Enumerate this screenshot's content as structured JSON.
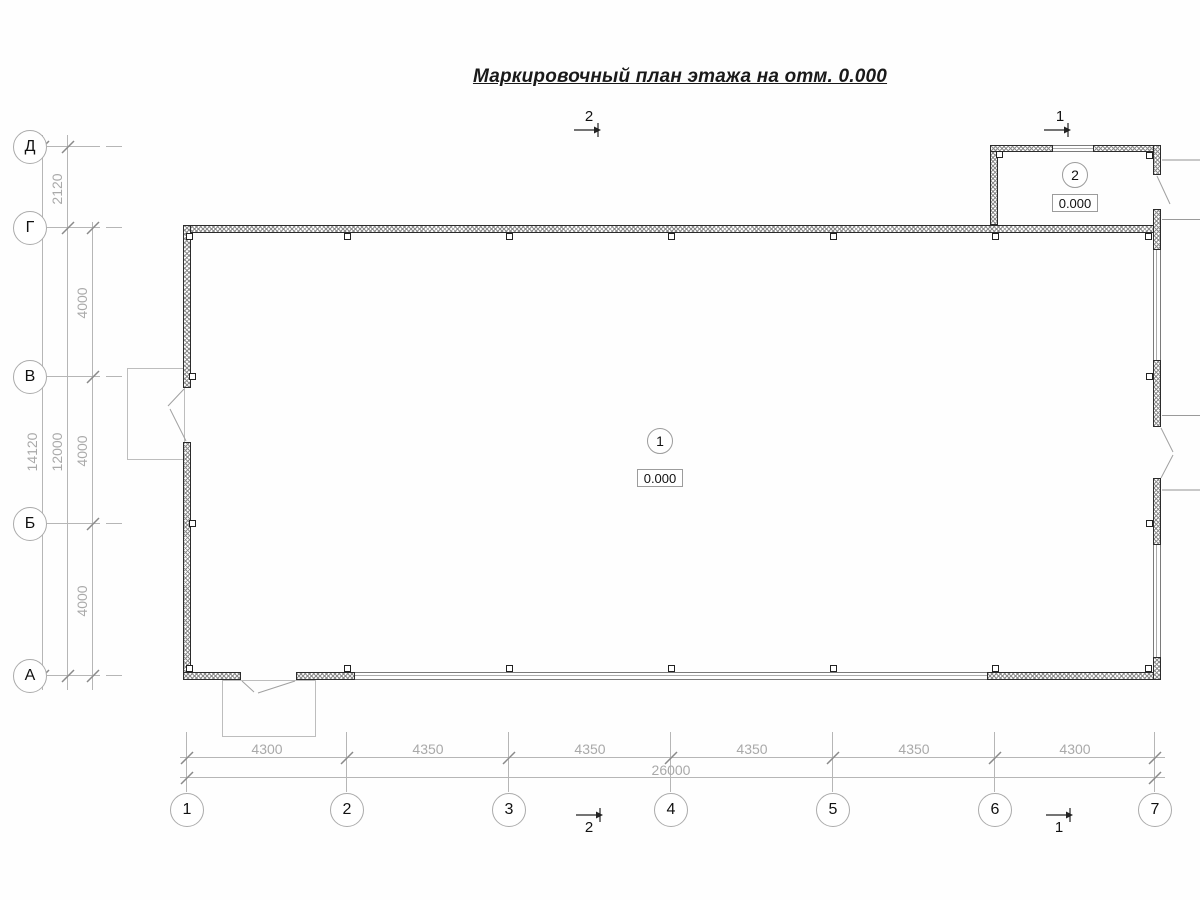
{
  "title": "Маркировочный план этажа на отм. 0.000",
  "axes": {
    "rows": [
      "Д",
      "Г",
      "В",
      "Б",
      "А"
    ],
    "cols": [
      "1",
      "2",
      "3",
      "4",
      "5",
      "6",
      "7"
    ]
  },
  "dims": {
    "left": {
      "d_to_g": "2120",
      "spans": [
        "4000",
        "4000",
        "4000"
      ],
      "g_to_a": "12000",
      "total": "14120"
    },
    "bottom": {
      "spans": [
        "4300",
        "4350",
        "4350",
        "4350",
        "4350",
        "4300"
      ],
      "total": "26000"
    }
  },
  "rooms": [
    {
      "number": "1",
      "elevation": "0.000"
    },
    {
      "number": "2",
      "elevation": "0.000"
    }
  ],
  "sections": {
    "top": [
      "2",
      "1"
    ],
    "bottom": [
      "2",
      "1"
    ]
  },
  "colors": {
    "wall_outline": "#2b2b2b",
    "dimension_line": "#b6b6b6",
    "dimension_text": "#a9a9a9",
    "drawing_text": "#1a1a1a"
  }
}
